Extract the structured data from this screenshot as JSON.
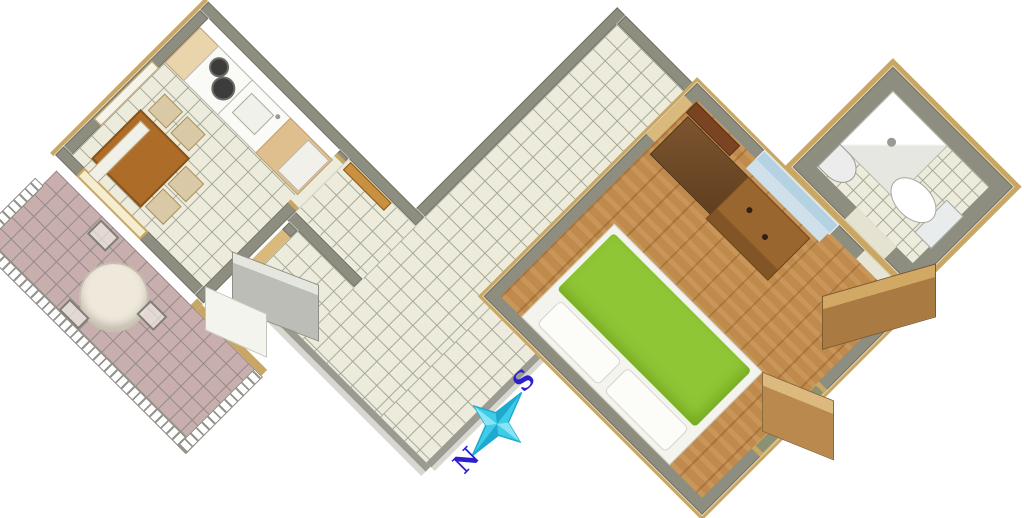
{
  "title": "Apartment floor plan (3D top view)",
  "compass": {
    "south_label": "S",
    "north_label": "N"
  },
  "palette": {
    "bg": "#ffffff",
    "wall": "#8d8d80",
    "wall_edge": "#6f6f64",
    "tile_floor": "#edecdc",
    "tile_grid": "#a6a998",
    "terrace_floor": "#c9aeae",
    "terrace_grid": "#94898b",
    "wood": "#c08a4c",
    "bed_green": "#8fc636",
    "pillow": "#f4f4ef",
    "counter_wood": "#dfbf8e",
    "cabinet_tan": "#e9d4ac",
    "wardrobe_brown": "#6f4a27",
    "desk_brown": "#9a6630",
    "table_brown": "#ad6c28",
    "chair_beige": "#d9c9a6",
    "trim_gold": "#c9a763",
    "rail_line": "#94948c",
    "glass_blue": "#b5d2e2",
    "sill_blue": "#cfe0ea",
    "pane_olive": "#8b9172",
    "appliance": "#fafaf7",
    "burner": "#3c3c3c",
    "door_white": "#d9d9d3",
    "door_tan": "#c99a58",
    "edge_gray": "#9b9b91",
    "edge_light": "#d8d8d0",
    "compass_cyan": "#3ecde8",
    "compass_dark": "#1fa9cf",
    "letter_blue": "#2b1fd0"
  },
  "rooms": [
    {
      "id": "kitchen-dining",
      "floor": "cream-tiles",
      "features": [
        "kitchen-counter",
        "cooktop-two-burners",
        "sink",
        "dining-table",
        "four-chairs",
        "terrace-door",
        "side-window"
      ]
    },
    {
      "id": "terrace",
      "floor": "pink-tiles",
      "features": [
        "railing",
        "round-table",
        "three-chairs",
        "gold-fence"
      ]
    },
    {
      "id": "hallway",
      "floor": "cream-tiles",
      "features": [
        "vestibule",
        "entrance-door-open"
      ]
    },
    {
      "id": "bedroom",
      "floor": "wood-parquet",
      "features": [
        "green-double-bed",
        "two-pillows",
        "wardrobe",
        "desk",
        "top-window",
        "side-window",
        "balcony-door-open",
        "room-door-open"
      ]
    },
    {
      "id": "bathroom",
      "floor": "cream-tiles",
      "features": [
        "shower",
        "washbasin",
        "toilet",
        "door-open"
      ]
    }
  ]
}
